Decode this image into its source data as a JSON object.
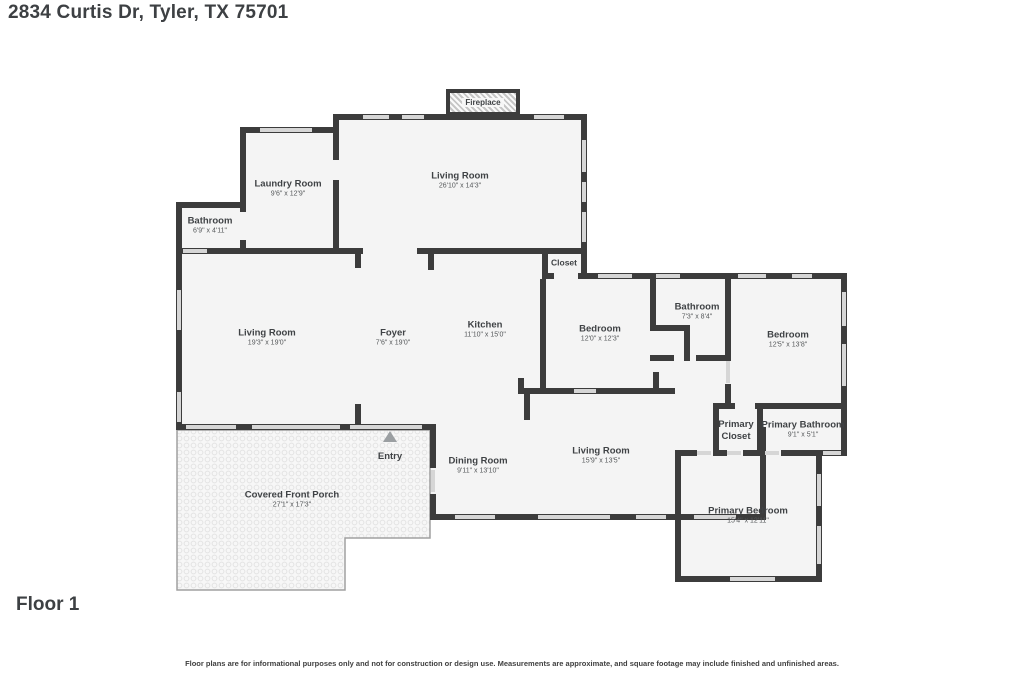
{
  "header": {
    "title": "2834 Curtis Dr, Tyler, TX 75701"
  },
  "floor_label": "Floor 1",
  "disclaimer": "Floor plans are for informational purposes only and not for construction or design use. Measurements are approximate, and square footage may include finished and unfinished areas.",
  "fireplace_label": "Fireplace",
  "entry_label": "Entry",
  "rooms": [
    {
      "name": "Living Room",
      "dims": "26'10\" x 14'3\""
    },
    {
      "name": "Laundry Room",
      "dims": "9'6\" x 12'9\""
    },
    {
      "name": "Bathroom",
      "dims": "6'9\" x 4'11\""
    },
    {
      "name": "Living Room",
      "dims": "19'3\" x 19'0\""
    },
    {
      "name": "Foyer",
      "dims": "7'6\" x 19'0\""
    },
    {
      "name": "Kitchen",
      "dims": "11'10\" x 15'0\""
    },
    {
      "name": "Closet",
      "dims": ""
    },
    {
      "name": "Bedroom",
      "dims": "12'0\" x 12'3\""
    },
    {
      "name": "Bathroom",
      "dims": "7'3\" x 8'4\""
    },
    {
      "name": "Bedroom",
      "dims": "12'5\" x 13'8\""
    },
    {
      "name": "Primary Closet",
      "dims": ""
    },
    {
      "name": "Primary Bathroom",
      "dims": "9'1\" x 5'1\""
    },
    {
      "name": "Living Room",
      "dims": "15'9\" x 13'5\""
    },
    {
      "name": "Dining Room",
      "dims": "9'11\" x 13'10\""
    },
    {
      "name": "Primary Bedroom",
      "dims": "15'4\" x 12'11\""
    },
    {
      "name": "Covered Front Porch",
      "dims": "27'1\" x 17'3\""
    }
  ],
  "colors": {
    "wall": "#3c3c3c",
    "room_fill": "#f4f4f4",
    "window": "#d6d6d6",
    "text": "#3f4245",
    "porch_outline": "#a0a0a0"
  }
}
